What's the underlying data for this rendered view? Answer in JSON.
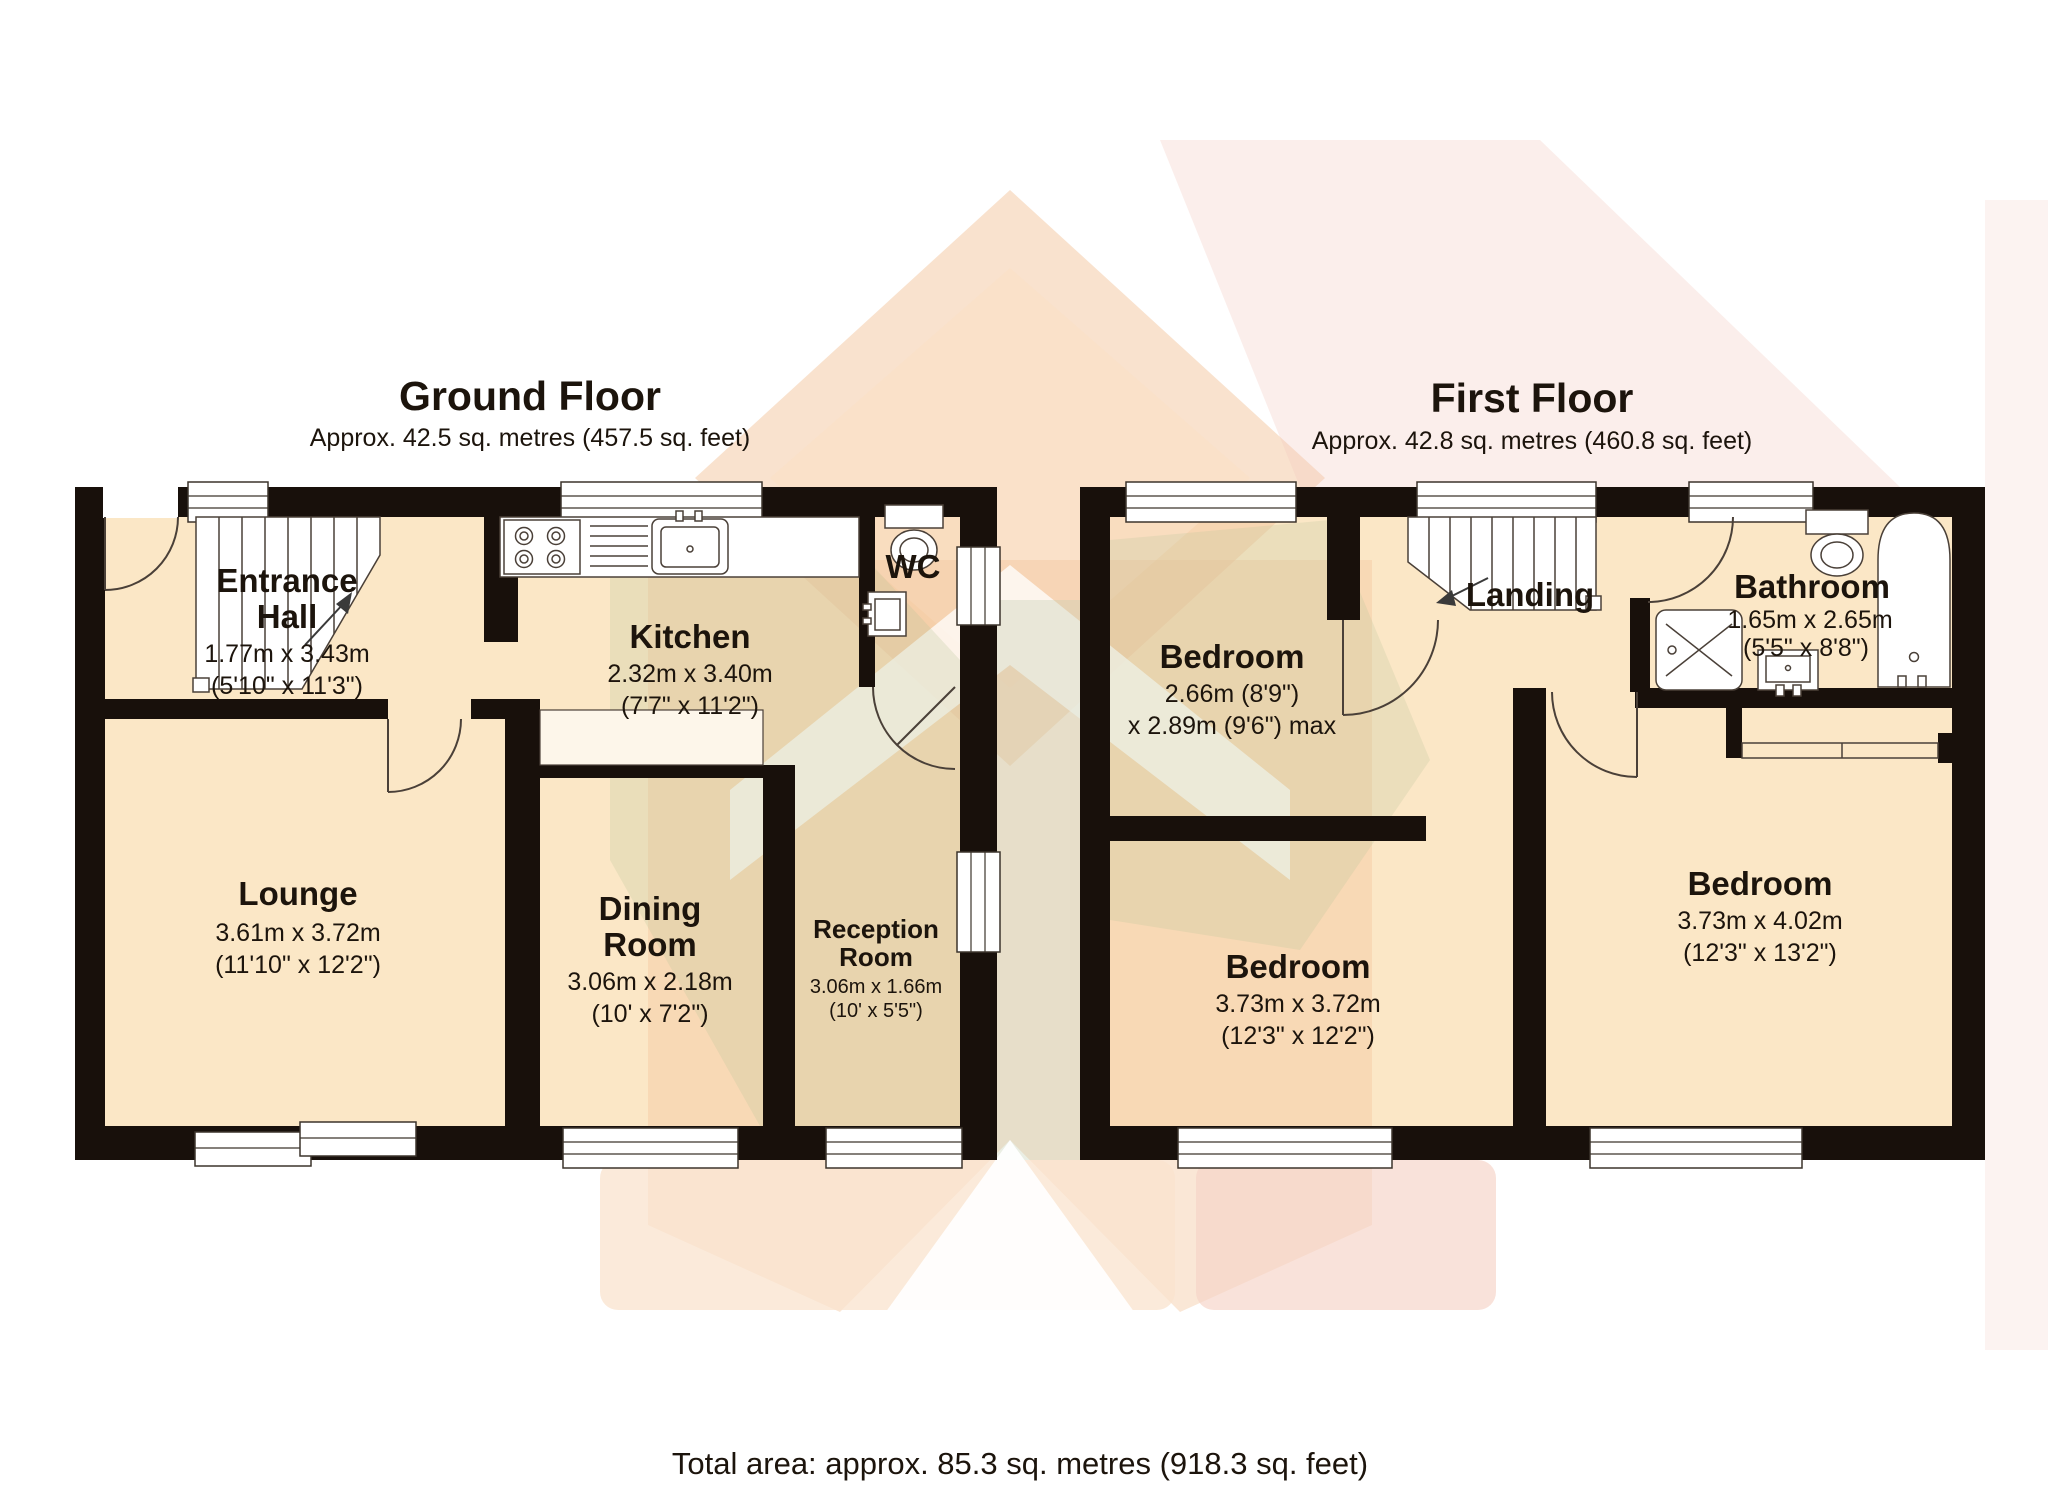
{
  "document": {
    "type": "estate-agent floor plan",
    "footer_total": "Total area: approx. 85.3 sq. metres (918.3 sq. feet)"
  },
  "colors": {
    "wall": "#18100b",
    "floor_fill": "#fbe7c6",
    "watermark_peach": "#f4c69e",
    "watermark_pink": "#f3c8bd",
    "watermark_sage": "#b9c49a",
    "background": "#ffffff"
  },
  "ground": {
    "title": "Ground Floor",
    "subtitle": "Approx. 42.5 sq. metres (457.5 sq. feet)",
    "rooms": {
      "entrance_hall": {
        "line1": "Entrance",
        "line2": "Hall",
        "metric": "1.77m x 3.43m",
        "imperial": "(5'10\" x 11'3\")"
      },
      "kitchen": {
        "label": "Kitchen",
        "metric": "2.32m x 3.40m",
        "imperial": "(7'7\" x 11'2\")"
      },
      "wc": {
        "label": "WC"
      },
      "lounge": {
        "label": "Lounge",
        "metric": "3.61m x 3.72m",
        "imperial": "(11'10\" x 12'2\")"
      },
      "dining": {
        "line1": "Dining",
        "line2": "Room",
        "metric": "3.06m x 2.18m",
        "imperial": "(10' x 7'2\")"
      },
      "reception": {
        "line1": "Reception",
        "line2": "Room",
        "metric": "3.06m x 1.66m",
        "imperial": "(10' x 5'5\")"
      }
    }
  },
  "first": {
    "title": "First Floor",
    "subtitle": "Approx. 42.8 sq. metres (460.8 sq. feet)",
    "rooms": {
      "bedroom_front": {
        "label": "Bedroom",
        "metric": "2.66m (8'9\")",
        "imperial": "x 2.89m (9'6\") max"
      },
      "landing": {
        "label": "Landing"
      },
      "bathroom": {
        "label": "Bathroom",
        "metric": "1.65m x 2.65m",
        "imperial": "(5'5\" x 8'8\")"
      },
      "bedroom_back_left": {
        "label": "Bedroom",
        "metric": "3.73m x 3.72m",
        "imperial": "(12'3\" x 12'2\")"
      },
      "bedroom_back_right": {
        "label": "Bedroom",
        "metric": "3.73m x 4.02m",
        "imperial": "(12'3\" x 13'2\")"
      }
    }
  }
}
